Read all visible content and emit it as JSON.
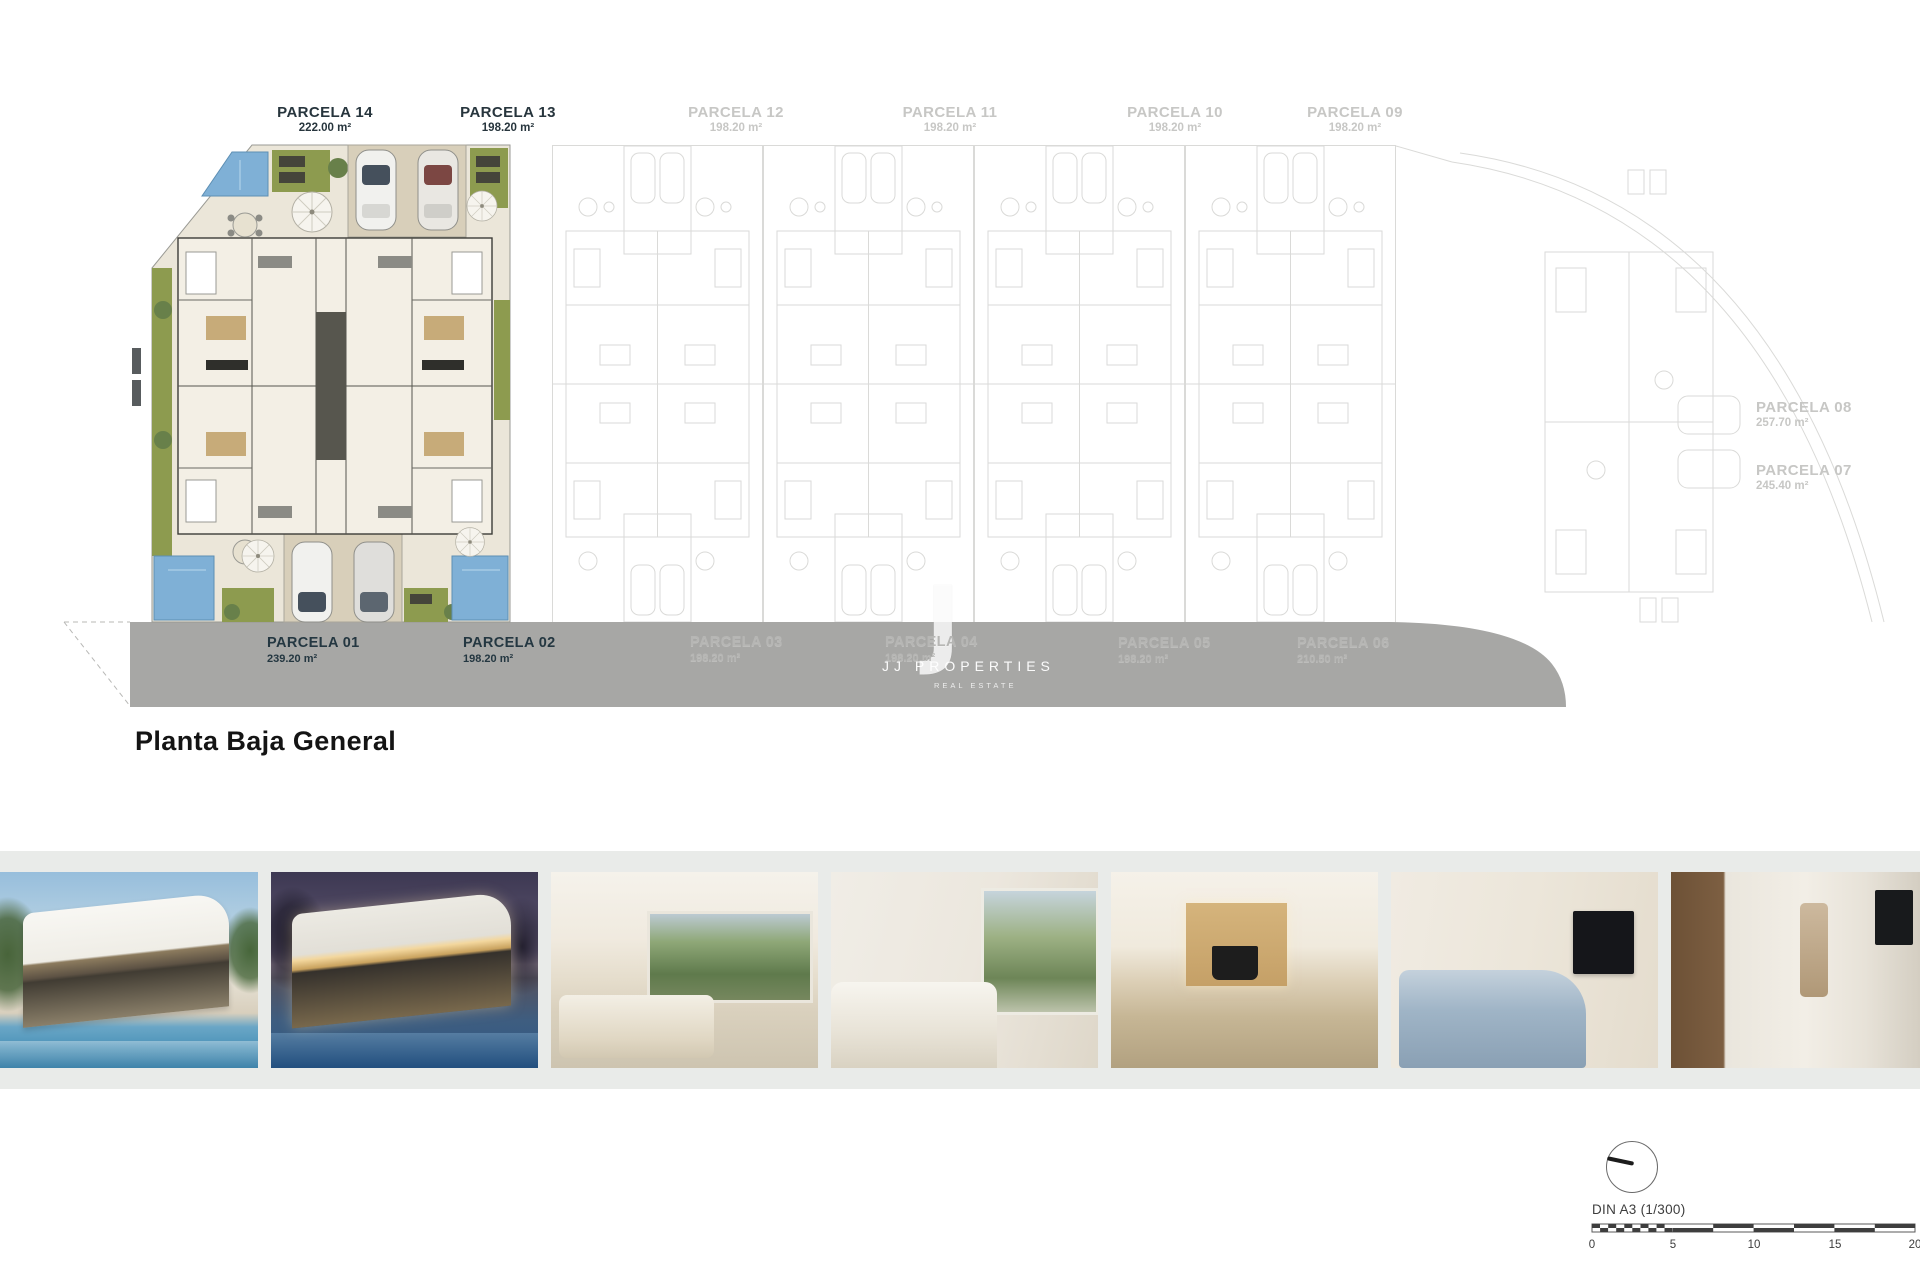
{
  "page": {
    "title": "Planta Baja General"
  },
  "watermark": {
    "initial": "J",
    "name": "JJ PROPERTIES",
    "tagline": "REAL ESTATE"
  },
  "parcels": {
    "top": [
      {
        "name": "PARCELA 14",
        "area": "222.00 m²"
      },
      {
        "name": "PARCELA 13",
        "area": "198.20 m²"
      },
      {
        "name": "PARCELA 12",
        "area": "198.20 m²"
      },
      {
        "name": "PARCELA 11",
        "area": "198.20 m²"
      },
      {
        "name": "PARCELA 10",
        "area": "198.20 m²"
      },
      {
        "name": "PARCELA 09",
        "area": "198.20 m²"
      }
    ],
    "right": [
      {
        "name": "PARCELA 08",
        "area": "257.70 m²"
      },
      {
        "name": "PARCELA 07",
        "area": "245.40 m²"
      }
    ],
    "road": [
      {
        "name": "PARCELA 01",
        "area": "239.20 m²"
      },
      {
        "name": "PARCELA 02",
        "area": "198.20 m²"
      },
      {
        "name": "PARCELA 03",
        "area": "198.20 m²"
      },
      {
        "name": "PARCELA 04",
        "area": "198.20 m²"
      },
      {
        "name": "PARCELA 05",
        "area": "198.20 m²"
      },
      {
        "name": "PARCELA 06",
        "area": "210.50 m²"
      }
    ]
  },
  "scale": {
    "label": "DIN A3 (1/300)",
    "ticks": [
      "0",
      "5",
      "10",
      "15",
      "20"
    ]
  },
  "photos": [
    {
      "name": "villa-exterior-day"
    },
    {
      "name": "villa-exterior-dusk"
    },
    {
      "name": "living-dining-interior"
    },
    {
      "name": "living-room-interior"
    },
    {
      "name": "kitchen-dining-interior"
    },
    {
      "name": "bedroom-interior"
    },
    {
      "name": "bathroom-interior"
    }
  ],
  "colors": {
    "accent_navy": "#26353E",
    "road_gray": "#A7A7A5",
    "pool_blue": "#7FB0D6",
    "grass_green": "#8D9B4F",
    "faded_line": "#DADAD8"
  }
}
